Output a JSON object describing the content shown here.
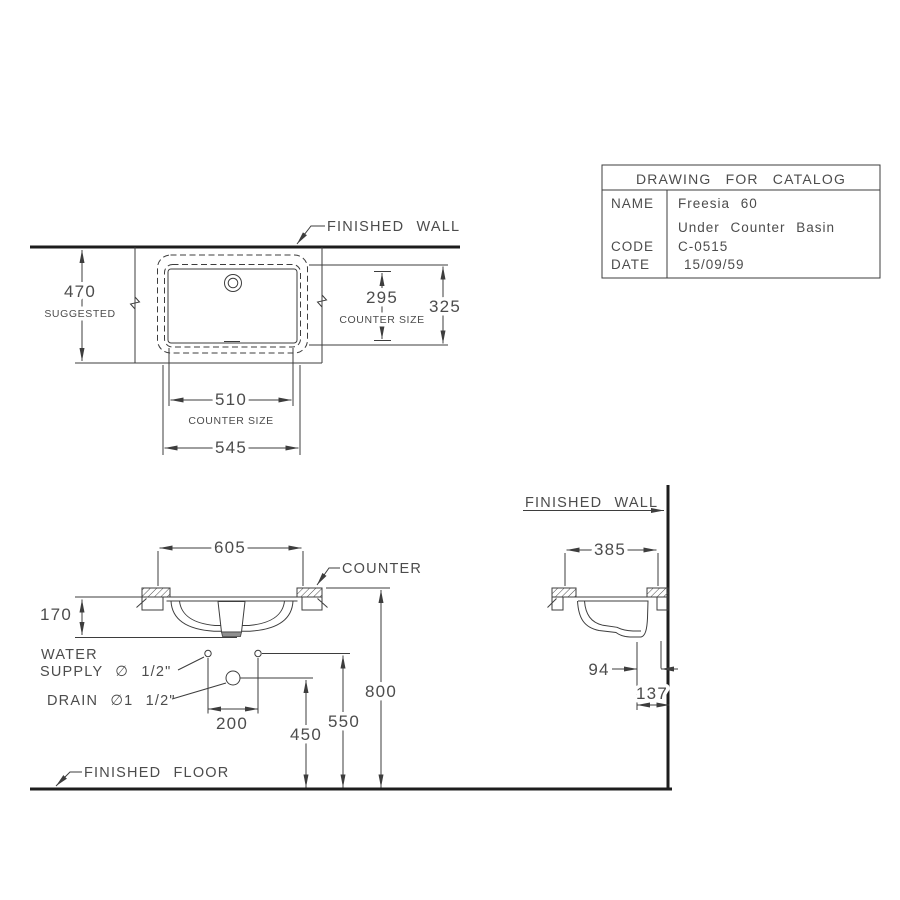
{
  "colors": {
    "background": "#ffffff",
    "line": "#3d3d3d",
    "heavy_line": "#1d1d1d",
    "text": "#4c4c4c",
    "drain_shade": "#8f8f8f"
  },
  "title_block": {
    "title": "DRAWING FOR CATALOG",
    "name_label": "NAME",
    "name_value_line1": "Freesia 60",
    "name_value_line2": "Under Counter Basin",
    "code_label": "CODE",
    "code_value": "C-0515",
    "date_label": "DATE",
    "date_value": "15/09/59"
  },
  "top_view": {
    "finished_wall_label": "FINISHED WALL",
    "dim_depth_suggested": {
      "value": "470",
      "note": "SUGGESTED"
    },
    "dim_counter_depth": {
      "value": "295",
      "note": "COUNTER SIZE"
    },
    "dim_overall_depth": {
      "value": "325"
    },
    "dim_counter_width": {
      "value": "510",
      "note": "COUNTER SIZE"
    },
    "dim_overall_width": {
      "value": "545"
    }
  },
  "front_view": {
    "dim_width": "605",
    "counter_label": "COUNTER",
    "dim_bowl_depth": "170",
    "water_supply_label_line1": "WATER",
    "water_supply_label_line2": "SUPPLY ∅ 1/2\"",
    "drain_label": "DRAIN ∅1 1/2\"",
    "dim_supply_spacing": "200",
    "dim_drain_height": "450",
    "dim_supply_height": "550",
    "dim_counter_height": "800",
    "finished_floor_label": "FINISHED FLOOR"
  },
  "side_view": {
    "finished_wall_label": "FINISHED WALL",
    "dim_depth": "385",
    "dim_drain_to_back": "94",
    "dim_drain_to_wall": "137"
  }
}
